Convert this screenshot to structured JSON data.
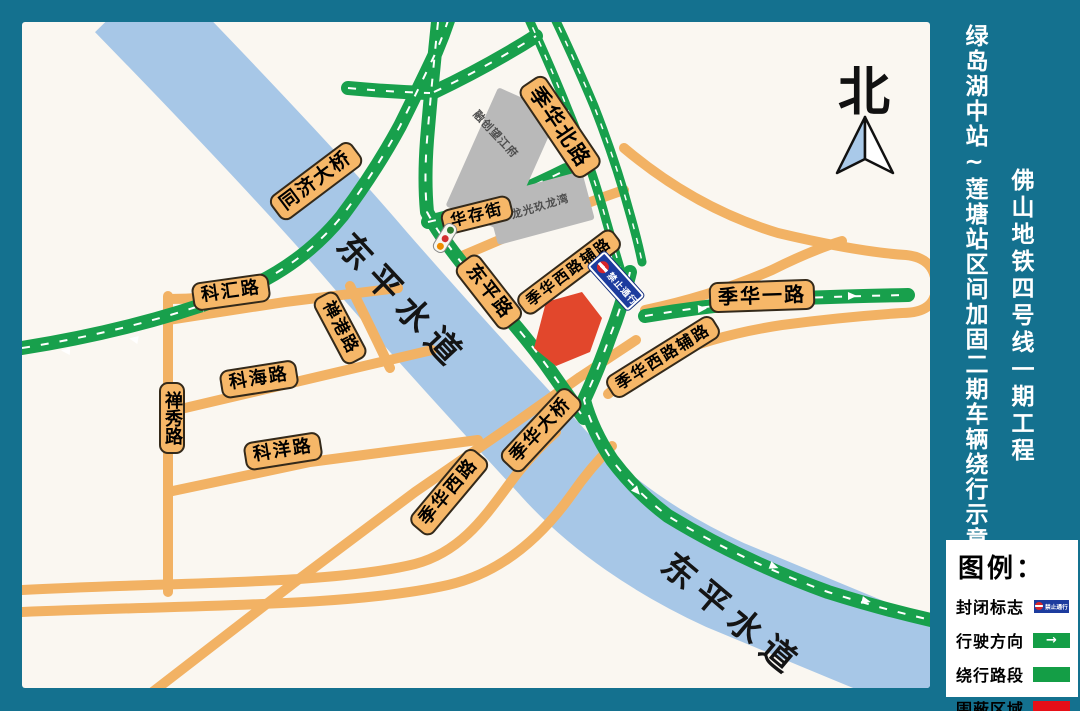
{
  "header": {
    "project_title": "佛山地铁四号线一期工程",
    "diagram_title": "绿岛湖中站~莲塘站区间加固二期车辆绕行示意图"
  },
  "compass": {
    "north_label": "北"
  },
  "map": {
    "river": {
      "name_upper": "东平水道",
      "name_lower": "东平水道"
    },
    "roads": {
      "tongji_bridge": "同济大桥",
      "kehui_road": "科汇路",
      "changang_road": "禅港路",
      "kehai_road": "科海路",
      "chanxiu_road": "禅秀路",
      "keyang_road": "科洋路",
      "dongping_road": "东平路",
      "huacun_street": "华存街",
      "jihua_north_road": "季华北路",
      "jihua_west_aux_upper": "季华西路辅路",
      "jihua_one_road": "季华一路",
      "jihua_west_aux_right": "季华西路辅路",
      "jihua_bridge": "季华大桥",
      "jihua_west_road": "季华西路"
    },
    "buildings": {
      "sunac": "融创望江府",
      "longguang": "龙光玖龙湾"
    },
    "closure_sign_text": "禁止通行"
  },
  "legend": {
    "title": "图例：",
    "items": [
      {
        "label": "封闭标志"
      },
      {
        "label": "行驶方向"
      },
      {
        "label": "绕行路段"
      },
      {
        "label": "围蔽区域"
      }
    ],
    "closure_sign_text": "禁止通行",
    "arrow_glyph": "→"
  },
  "colors": {
    "border_teal": "#14718f",
    "map_bg": "#faf7f1",
    "river_blue": "#a7c7e7",
    "road_orange": "#f2b264",
    "detour_green": "#18a04c",
    "closed_red": "#e2472c",
    "legend_green": "#149e46",
    "legend_red": "#e60f17",
    "sign_blue": "#1d3c9e"
  }
}
